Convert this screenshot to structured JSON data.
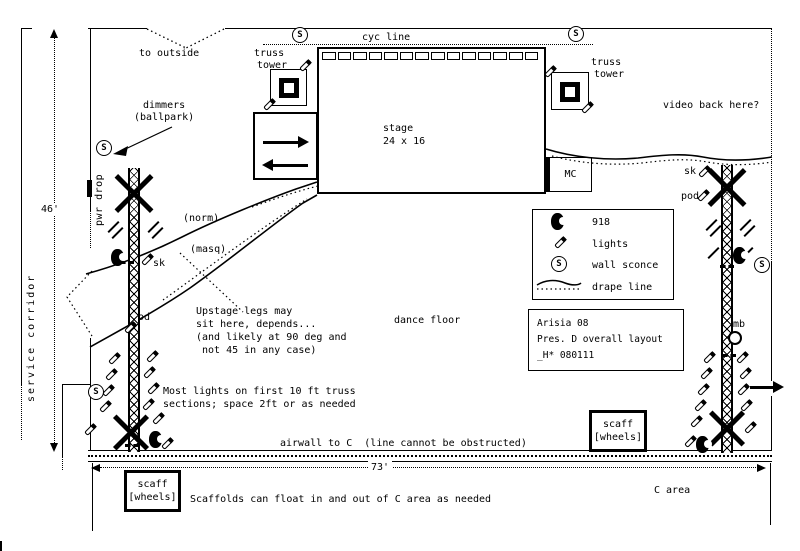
{
  "colors": {
    "ink": "#000000",
    "paper": "#ffffff"
  },
  "top": {
    "to_outside": "to outside",
    "cyc_line": "cyc line",
    "truss_tower_line1": "truss",
    "truss_tower_line2": "tower",
    "video_back": "video back here?",
    "sconce_letter": "S"
  },
  "stage": {
    "name": "stage",
    "size": "24 x 16"
  },
  "mc_label": "MC",
  "left": {
    "dimmers_line1": "dimmers",
    "dimmers_line2": "(ballpark)",
    "pwr_drop": "pwr drop",
    "service_corridor": "service corridor",
    "dim_height": "46'",
    "norm": "(norm)",
    "masq": "(masq)",
    "sk": "sk",
    "pod": "pod"
  },
  "right": {
    "sk": "sk",
    "pod": "pod",
    "mb": "mb"
  },
  "legend": {
    "items": [
      {
        "icon": "918-icon",
        "label": "918"
      },
      {
        "icon": "light-icon",
        "label": "lights"
      },
      {
        "icon": "wall-sconce-icon",
        "label": "wall sconce"
      },
      {
        "icon": "drape-line-icon",
        "label": "drape line"
      }
    ]
  },
  "info_box": {
    "line1": "Arisia 08",
    "line2": "Pres. D overall layout",
    "line3": "_H* 080111"
  },
  "scaff_box": {
    "line1": "scaff",
    "line2": "[wheels]"
  },
  "notes": {
    "upstage": [
      "Upstage legs may",
      "sit here, depends...",
      "(and likely at 90 deg and",
      " not 45 in any case)"
    ],
    "most_lights": [
      "Most lights on first 10 ft truss",
      "sections; space 2ft or as needed"
    ],
    "dance_floor": "dance floor",
    "airwall": "airwall to C  (line cannot be obstructed)",
    "scaffolds": "Scaffolds can float in and out of C area as needed",
    "c_area": "C area",
    "dim_width": "73'"
  }
}
